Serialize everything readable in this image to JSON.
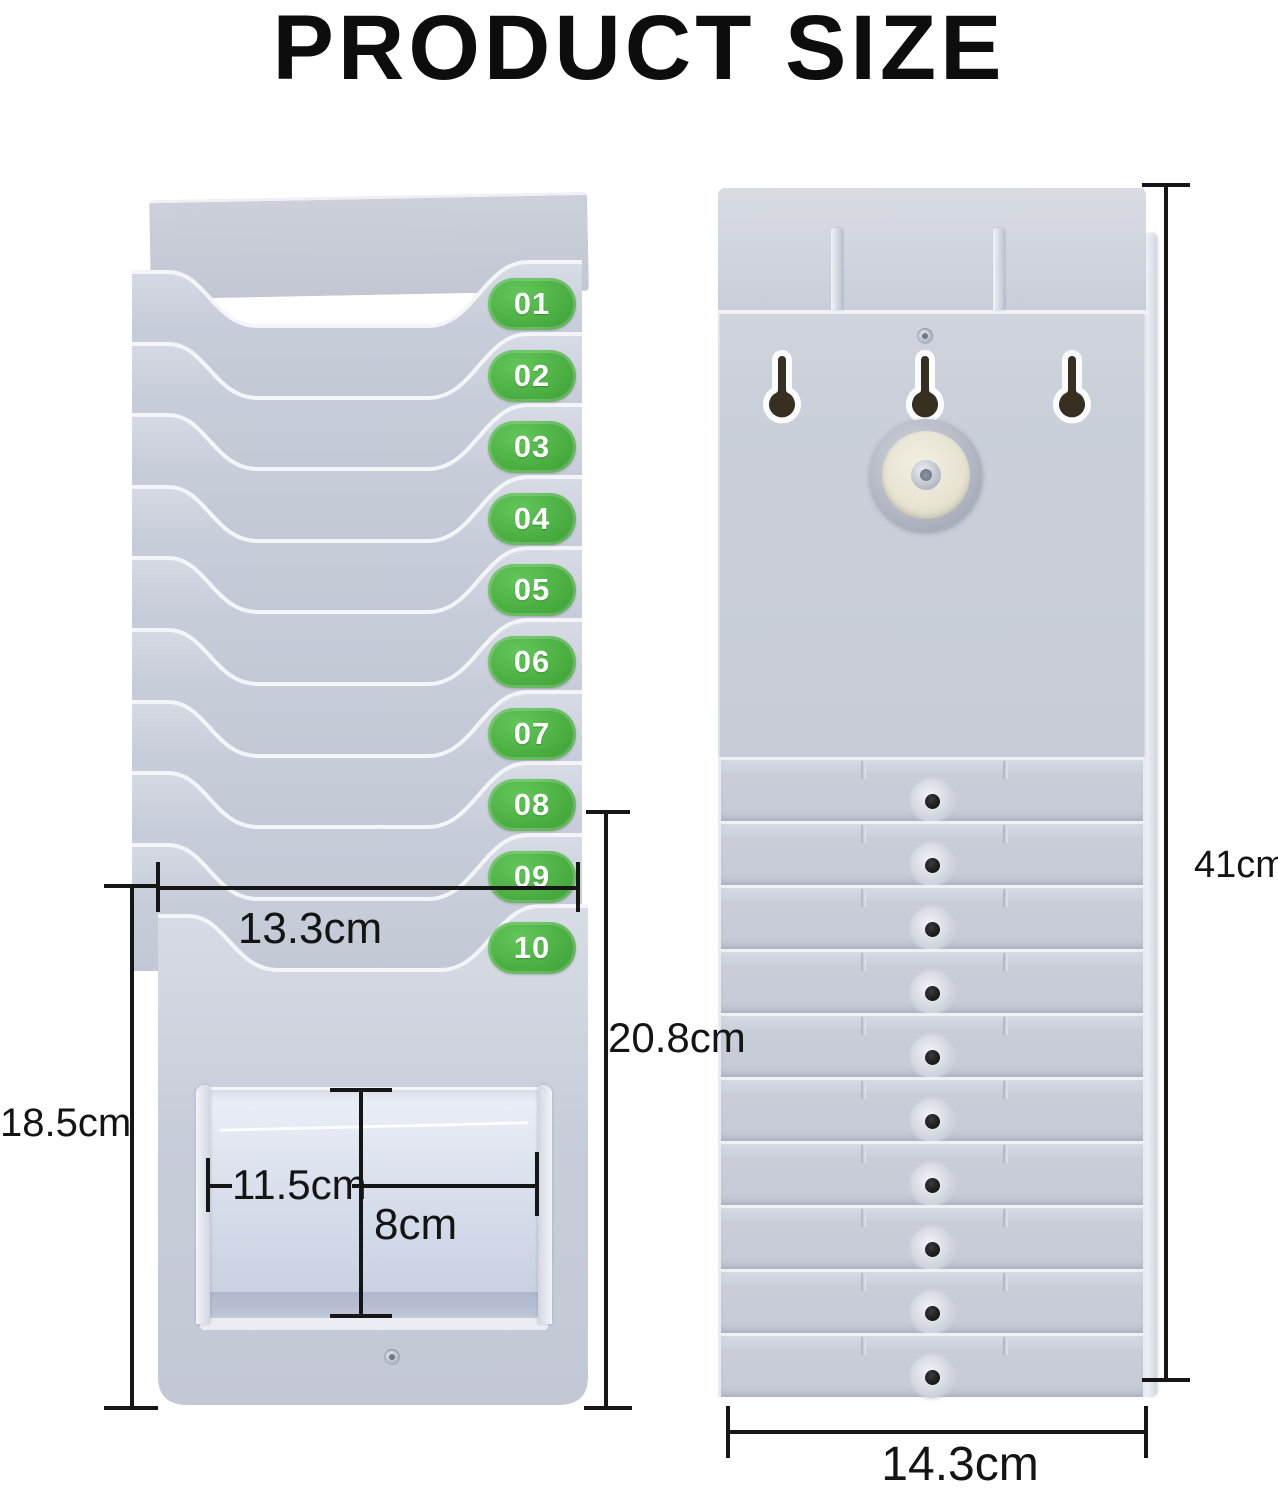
{
  "title": "PRODUCT SIZE",
  "front_view": {
    "slot_labels": [
      "01",
      "02",
      "03",
      "04",
      "05",
      "06",
      "07",
      "08",
      "09",
      "10"
    ]
  },
  "dimensions": {
    "slot_width": "13.3cm",
    "lower_section_height": "18.5cm",
    "card_section_height": "20.8cm",
    "pocket_width": "11.5cm",
    "pocket_height": "8cm",
    "total_height": "41cm",
    "overall_width": "14.3cm"
  },
  "colors": {
    "body_gray": "#c7ccd7",
    "badge_green": "#4cb043",
    "dimension_line": "#161616",
    "keyhole_dark": "#372f1f",
    "lock_disc": "#e7e3d3"
  }
}
